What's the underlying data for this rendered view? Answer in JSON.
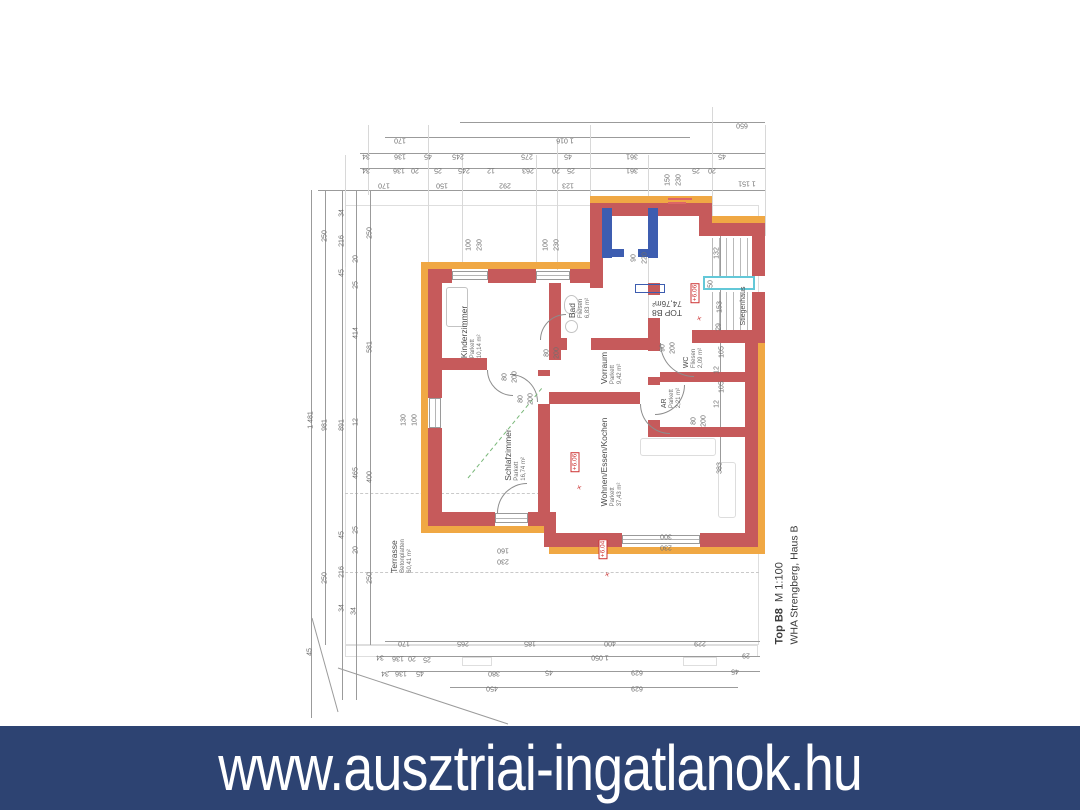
{
  "banner": {
    "url_text": "www.ausztriai-ingatlanok.hu"
  },
  "title_block": {
    "unit": "Top B8",
    "scale": "M 1:100",
    "project": "WHA Strengberg, Haus B"
  },
  "unit_stamp": {
    "line1": "TOP B8",
    "line2": "74,76m²"
  },
  "colors": {
    "banner_bg": "#2d4372",
    "banner_text": "#ffffff",
    "wall_red": "#c65a5b",
    "insulation_orange": "#f0a844",
    "neighbor_blue": "#3d5db0",
    "stair_cyan": "#63c8d8",
    "level_marker_red": "#cc3333",
    "dim_text": "#6e6e6e"
  },
  "rooms": [
    {
      "name": "Kinderzimmer",
      "floor": "Parkett",
      "area": "10,14 m²",
      "x": 472,
      "y": 332,
      "size": "n"
    },
    {
      "name": "Bad",
      "floor": "Fliesen",
      "area": "6,83 m²",
      "x": 580,
      "y": 308,
      "size": "n"
    },
    {
      "name": "Schlafzimmer",
      "floor": "Parkett",
      "area": "16,74 m²",
      "x": 516,
      "y": 455,
      "size": "n"
    },
    {
      "name": "Vorraum",
      "floor": "Parkett",
      "area": "9,42 m²",
      "x": 612,
      "y": 368,
      "size": "n"
    },
    {
      "name": "Wohnen/Essen/Kochen",
      "floor": "Parkett",
      "area": "37,43 m²",
      "x": 612,
      "y": 462,
      "size": "n"
    },
    {
      "name": "WC",
      "floor": "Fliesen",
      "area": "2,09 m²",
      "x": 694,
      "y": 358,
      "size": "small"
    },
    {
      "name": "AR",
      "floor": "Parkett",
      "area": "2,21 m²",
      "x": 672,
      "y": 398,
      "size": "small"
    },
    {
      "name": "Terrasse",
      "floor": "Betonplatten",
      "area": "60,41 m²",
      "x": 402,
      "y": 556,
      "size": "n"
    },
    {
      "name": "Stiegenhaus",
      "floor": "",
      "area": "",
      "x": 744,
      "y": 306,
      "size": "small"
    }
  ],
  "level_markers": [
    {
      "text": "+6.06",
      "x": 575,
      "y": 462
    },
    {
      "text": "+6.04",
      "x": 603,
      "y": 549
    },
    {
      "text": "+6.06",
      "x": 695,
      "y": 293
    }
  ],
  "dim_labels": [
    {
      "t": "650",
      "x": 742,
      "y": 125,
      "r": "u"
    },
    {
      "t": "170",
      "x": 400,
      "y": 140,
      "r": "u"
    },
    {
      "t": "1 016",
      "x": 565,
      "y": 140,
      "r": "u"
    },
    {
      "t": "34",
      "x": 366,
      "y": 156,
      "r": "u"
    },
    {
      "t": "136",
      "x": 400,
      "y": 156,
      "r": "u"
    },
    {
      "t": "45",
      "x": 428,
      "y": 156,
      "r": "u"
    },
    {
      "t": "245",
      "x": 458,
      "y": 156,
      "r": "u"
    },
    {
      "t": "275",
      "x": 527,
      "y": 156,
      "r": "u"
    },
    {
      "t": "45",
      "x": 568,
      "y": 156,
      "r": "u"
    },
    {
      "t": "361",
      "x": 632,
      "y": 156,
      "r": "u"
    },
    {
      "t": "45",
      "x": 722,
      "y": 156,
      "r": "u"
    },
    {
      "t": "34",
      "x": 366,
      "y": 170,
      "r": "u"
    },
    {
      "t": "136",
      "x": 399,
      "y": 170,
      "r": "u"
    },
    {
      "t": "20",
      "x": 415,
      "y": 170,
      "r": "u"
    },
    {
      "t": "25",
      "x": 438,
      "y": 170,
      "r": "u"
    },
    {
      "t": "245",
      "x": 464,
      "y": 170,
      "r": "u"
    },
    {
      "t": "12",
      "x": 491,
      "y": 170,
      "r": "u"
    },
    {
      "t": "263",
      "x": 528,
      "y": 170,
      "r": "u"
    },
    {
      "t": "20",
      "x": 556,
      "y": 170,
      "r": "u"
    },
    {
      "t": "25",
      "x": 571,
      "y": 170,
      "r": "u"
    },
    {
      "t": "361",
      "x": 632,
      "y": 170,
      "r": "u"
    },
    {
      "t": "25",
      "x": 696,
      "y": 170,
      "r": "u"
    },
    {
      "t": "20",
      "x": 712,
      "y": 170,
      "r": "u"
    },
    {
      "t": "150",
      "x": 668,
      "y": 180,
      "r": "v"
    },
    {
      "t": "230",
      "x": 679,
      "y": 180,
      "r": "v"
    },
    {
      "t": "170",
      "x": 384,
      "y": 185,
      "r": "u"
    },
    {
      "t": "150",
      "x": 442,
      "y": 185,
      "r": "u"
    },
    {
      "t": "292",
      "x": 505,
      "y": 185,
      "r": "u"
    },
    {
      "t": "123",
      "x": 568,
      "y": 185,
      "r": "u"
    },
    {
      "t": "1 151",
      "x": 747,
      "y": 183,
      "r": "u"
    },
    {
      "t": "1 481",
      "x": 311,
      "y": 420,
      "r": "v"
    },
    {
      "t": "250",
      "x": 325,
      "y": 236,
      "r": "v"
    },
    {
      "t": "981",
      "x": 325,
      "y": 425,
      "r": "v"
    },
    {
      "t": "250",
      "x": 325,
      "y": 578,
      "r": "v"
    },
    {
      "t": "34",
      "x": 342,
      "y": 213,
      "r": "v"
    },
    {
      "t": "216",
      "x": 342,
      "y": 241,
      "r": "v"
    },
    {
      "t": "45",
      "x": 342,
      "y": 273,
      "r": "v"
    },
    {
      "t": "891",
      "x": 342,
      "y": 425,
      "r": "v"
    },
    {
      "t": "45",
      "x": 342,
      "y": 535,
      "r": "v"
    },
    {
      "t": "216",
      "x": 342,
      "y": 572,
      "r": "v"
    },
    {
      "t": "34",
      "x": 342,
      "y": 608,
      "r": "v"
    },
    {
      "t": "20",
      "x": 356,
      "y": 259,
      "r": "v"
    },
    {
      "t": "25",
      "x": 356,
      "y": 285,
      "r": "v"
    },
    {
      "t": "414",
      "x": 356,
      "y": 333,
      "r": "v"
    },
    {
      "t": "12",
      "x": 356,
      "y": 422,
      "r": "v"
    },
    {
      "t": "465",
      "x": 356,
      "y": 473,
      "r": "v"
    },
    {
      "t": "25",
      "x": 356,
      "y": 530,
      "r": "v"
    },
    {
      "t": "20",
      "x": 356,
      "y": 550,
      "r": "v"
    },
    {
      "t": "250",
      "x": 370,
      "y": 233,
      "r": "v"
    },
    {
      "t": "581",
      "x": 370,
      "y": 347,
      "r": "v"
    },
    {
      "t": "400",
      "x": 370,
      "y": 477,
      "r": "v"
    },
    {
      "t": "250",
      "x": 370,
      "y": 578,
      "r": "v"
    },
    {
      "t": "130",
      "x": 404,
      "y": 420,
      "r": "v"
    },
    {
      "t": "100",
      "x": 415,
      "y": 420,
      "r": "v"
    },
    {
      "t": "100",
      "x": 469,
      "y": 245,
      "r": "v"
    },
    {
      "t": "230",
      "x": 480,
      "y": 245,
      "r": "v"
    },
    {
      "t": "100",
      "x": 546,
      "y": 245,
      "r": "v"
    },
    {
      "t": "230",
      "x": 557,
      "y": 245,
      "r": "v"
    },
    {
      "t": "90",
      "x": 634,
      "y": 258,
      "r": "v"
    },
    {
      "t": "220",
      "x": 645,
      "y": 258,
      "r": "v"
    },
    {
      "t": "132",
      "x": 717,
      "y": 253,
      "r": "v"
    },
    {
      "t": "50",
      "x": 711,
      "y": 284,
      "r": "v"
    },
    {
      "t": "153",
      "x": 720,
      "y": 307,
      "r": "v"
    },
    {
      "t": "29",
      "x": 719,
      "y": 327,
      "r": "v"
    },
    {
      "t": "105",
      "x": 722,
      "y": 352,
      "r": "v"
    },
    {
      "t": "12",
      "x": 717,
      "y": 370,
      "r": "v"
    },
    {
      "t": "105",
      "x": 722,
      "y": 387,
      "r": "v"
    },
    {
      "t": "12",
      "x": 717,
      "y": 404,
      "r": "v"
    },
    {
      "t": "383",
      "x": 720,
      "y": 468,
      "r": "v"
    },
    {
      "t": "80",
      "x": 505,
      "y": 377,
      "r": "v"
    },
    {
      "t": "200",
      "x": 515,
      "y": 377,
      "r": "v"
    },
    {
      "t": "80",
      "x": 521,
      "y": 399,
      "r": "v"
    },
    {
      "t": "200",
      "x": 531,
      "y": 399,
      "r": "v"
    },
    {
      "t": "80",
      "x": 547,
      "y": 353,
      "r": "v"
    },
    {
      "t": "200",
      "x": 557,
      "y": 353,
      "r": "v"
    },
    {
      "t": "90",
      "x": 663,
      "y": 348,
      "r": "v"
    },
    {
      "t": "200",
      "x": 673,
      "y": 348,
      "r": "v"
    },
    {
      "t": "80",
      "x": 694,
      "y": 421,
      "r": "v"
    },
    {
      "t": "200",
      "x": 704,
      "y": 421,
      "r": "v"
    },
    {
      "t": "160",
      "x": 503,
      "y": 550,
      "r": "u"
    },
    {
      "t": "230",
      "x": 503,
      "y": 561,
      "r": "u"
    },
    {
      "t": "300",
      "x": 666,
      "y": 536,
      "r": "u"
    },
    {
      "t": "230",
      "x": 666,
      "y": 547,
      "r": "u"
    },
    {
      "t": "170",
      "x": 404,
      "y": 643,
      "r": "u"
    },
    {
      "t": "265",
      "x": 463,
      "y": 643,
      "r": "u"
    },
    {
      "t": "185",
      "x": 530,
      "y": 643,
      "r": "u"
    },
    {
      "t": "400",
      "x": 610,
      "y": 643,
      "r": "u"
    },
    {
      "t": "229",
      "x": 700,
      "y": 643,
      "r": "u"
    },
    {
      "t": "34",
      "x": 380,
      "y": 657,
      "r": "u"
    },
    {
      "t": "136",
      "x": 398,
      "y": 658,
      "r": "u"
    },
    {
      "t": "20",
      "x": 412,
      "y": 658,
      "r": "u"
    },
    {
      "t": "25",
      "x": 427,
      "y": 659,
      "r": "u"
    },
    {
      "t": "1 050",
      "x": 600,
      "y": 657,
      "r": "u"
    },
    {
      "t": "29",
      "x": 746,
      "y": 655,
      "r": "u"
    },
    {
      "t": "34",
      "x": 385,
      "y": 673,
      "r": "u"
    },
    {
      "t": "136",
      "x": 401,
      "y": 673,
      "r": "u"
    },
    {
      "t": "45",
      "x": 420,
      "y": 673,
      "r": "u"
    },
    {
      "t": "380",
      "x": 494,
      "y": 673,
      "r": "u"
    },
    {
      "t": "45",
      "x": 549,
      "y": 672,
      "r": "u"
    },
    {
      "t": "629",
      "x": 637,
      "y": 672,
      "r": "u"
    },
    {
      "t": "45",
      "x": 735,
      "y": 671,
      "r": "u"
    },
    {
      "t": "450",
      "x": 492,
      "y": 688,
      "r": "u"
    },
    {
      "t": "629",
      "x": 637,
      "y": 688,
      "r": "u"
    },
    {
      "t": "45",
      "x": 310,
      "y": 652,
      "r": "v"
    },
    {
      "t": "34",
      "x": 354,
      "y": 611,
      "r": "v"
    }
  ]
}
